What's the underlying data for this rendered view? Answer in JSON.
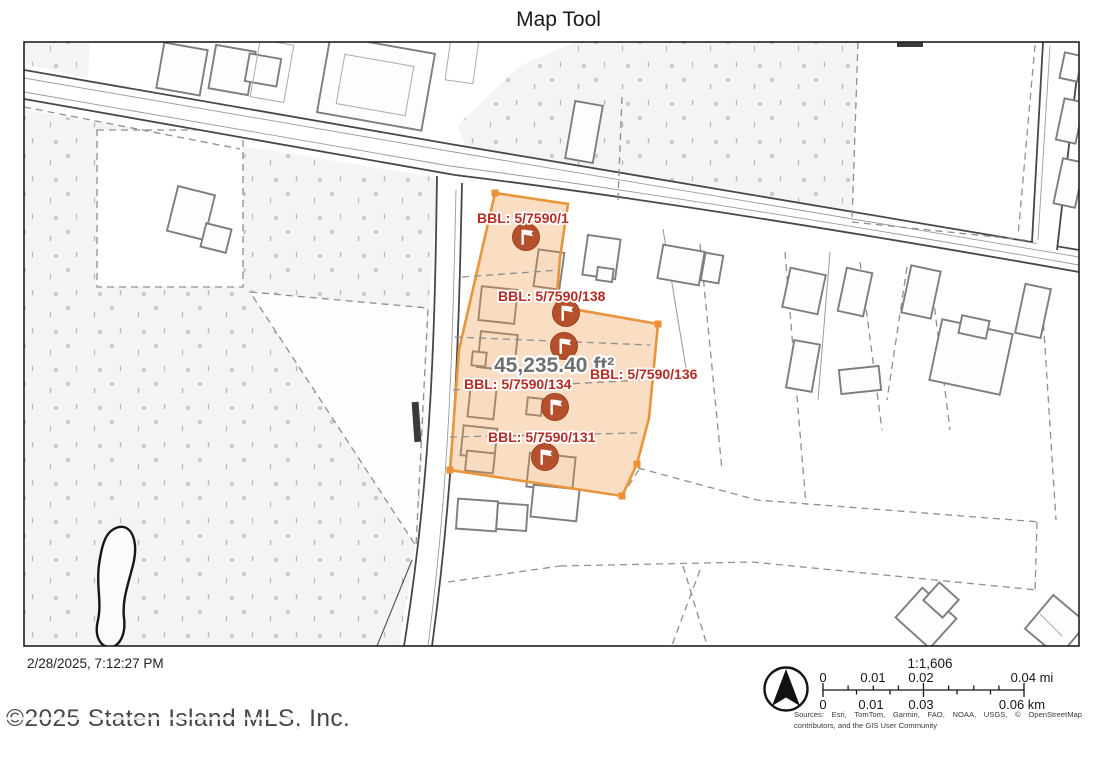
{
  "title": "Map Tool",
  "map": {
    "area_label": "45,235.40 ft²",
    "parcel_labels": [
      "BBL: 5/7590/1",
      "BBL: 5/7590/138",
      "BBL: 5/7590/136",
      "BBL: 5/7590/134",
      "BBL: 5/7590/131"
    ],
    "colors": {
      "highlight_fill": "#f09a48",
      "highlight_stroke": "#e8953c",
      "marker": "#b5502d",
      "parcel_label_text": "#b32d24",
      "area_label_text": "#6f6f6f"
    }
  },
  "footer": {
    "timestamp": "2/28/2025, 7:12:27 PM",
    "copyright": "©2025 Staten Island MLS, Inc."
  },
  "legend": {
    "scale_ratio": "1:1,606",
    "mi_labels": [
      "0",
      "0.01",
      "0.02",
      "0.04 mi"
    ],
    "km_labels": [
      "0",
      "0.01",
      "0.03",
      "0.06 km"
    ],
    "sources_line1": "Sources: Esri, TomTom, Garmin, FAO, NOAA, USGS, © OpenStreetMap",
    "sources_line2": "contributors, and the GIS User Community"
  }
}
